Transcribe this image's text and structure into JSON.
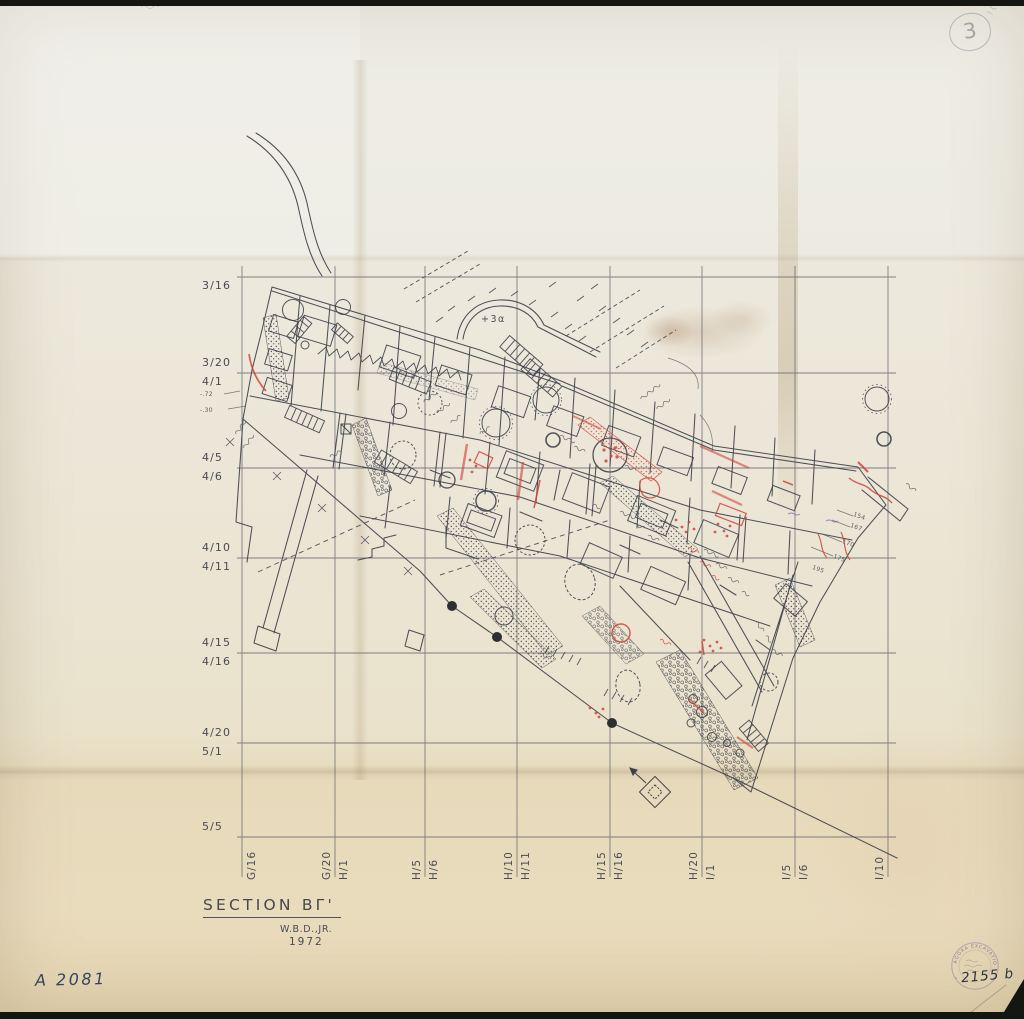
{
  "grid": {
    "row_labels": [
      "3/16",
      "3/20",
      "4/1",
      "4/5",
      "4/6",
      "4/10",
      "4/11",
      "4/15",
      "4/16",
      "4/20",
      "5/1",
      "5/5"
    ],
    "col_labels": [
      "G/16",
      "G/20",
      "H/1",
      "H/5",
      "H/6",
      "H/10",
      "H/11",
      "H/15",
      "H/16",
      "H/20",
      "I/1",
      "I/5",
      "I/6",
      "I/10"
    ]
  },
  "plan": {
    "elevation_note": "+3α",
    "spot_heights": [
      "154",
      "167",
      "170",
      "175",
      "195"
    ],
    "left_spot_elevations": [
      "-.72",
      "-.30"
    ]
  },
  "title_block": {
    "title": "SECTION BΓ'",
    "author": "W.B.D.,JR.",
    "year": "1972"
  },
  "catalog": {
    "inventory_number": "A 2081",
    "drawing_number": "2155 b",
    "circled_number": "3"
  },
  "stamp": {
    "rim_text": "AGORA EXCAVATIONS"
  },
  "colors": {
    "paper": "#ebe5d4",
    "paper_fold_tan": "#e7dabb",
    "ink": "#3f414b",
    "red_annotation": "#d0453c",
    "grid_line": "#5b5d68",
    "handwriting_ink": "#39435f",
    "stamp_purple": "#9b8aa8",
    "scan_background": "#141711"
  }
}
